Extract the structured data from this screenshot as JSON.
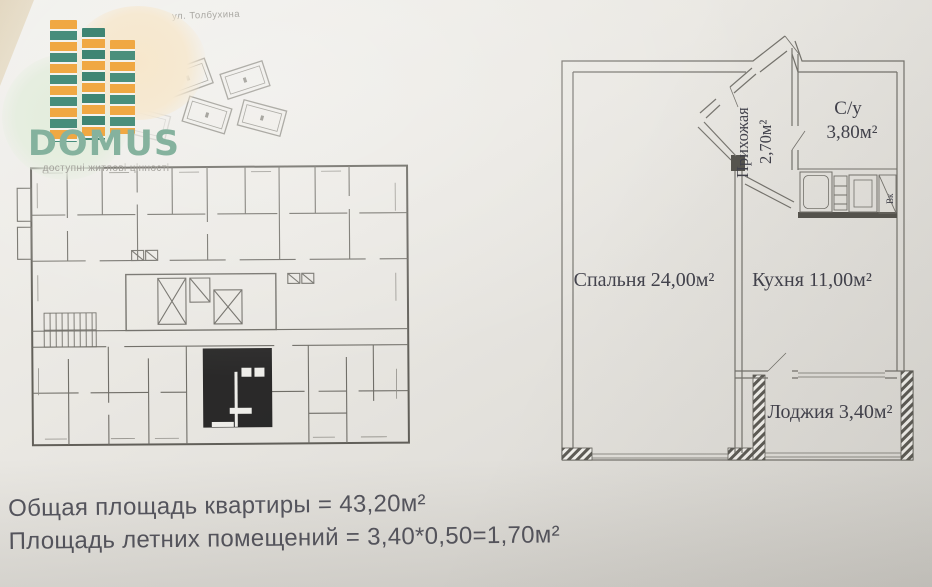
{
  "photo": {
    "street_label": "ул. Толбухина"
  },
  "logo": {
    "brand": "DOMUS",
    "tagline": "доступні житлові цінності",
    "colors": {
      "brand_green": "#85b29e",
      "block_teal": "#478d7b",
      "block_orange": "#f0a843"
    }
  },
  "apartment_plan": {
    "bedroom_label": "Спальня 24,00м²",
    "kitchen_label": "Кухня 11,00м²",
    "hallway_label": "Прихожая",
    "hallway_area": "2,70м²",
    "bathroom_label": "С/у",
    "bathroom_area": "3,80м²",
    "loggia_label": "Лоджия 3,40м²",
    "vent_label": "Вк"
  },
  "summary": {
    "total_area": "Общая площадь квартиры = 43,20м²",
    "summer_area": "Площадь летних помещений = 3,40*0,50=1,70м²"
  }
}
